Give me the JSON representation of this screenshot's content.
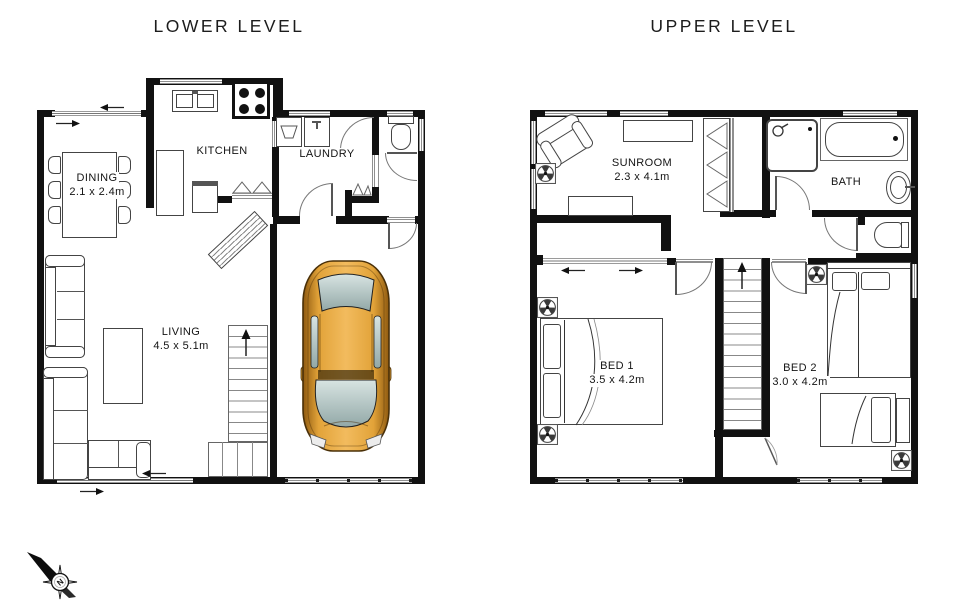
{
  "titles": {
    "lower": "LOWER LEVEL",
    "upper": "UPPER LEVEL"
  },
  "lower_level": {
    "rooms": {
      "dining": {
        "name": "DINING",
        "dims": "2.1 x 2.4m"
      },
      "kitchen": {
        "name": "KITCHEN",
        "dims": ""
      },
      "laundry": {
        "name": "LAUNDRY",
        "dims": ""
      },
      "living": {
        "name": "LIVING",
        "dims": "4.5 x 5.1m"
      }
    }
  },
  "upper_level": {
    "rooms": {
      "sunroom": {
        "name": "SUNROOM",
        "dims": "2.3 x 4.1m"
      },
      "bath": {
        "name": "BATH",
        "dims": ""
      },
      "bed1": {
        "name": "BED 1",
        "dims": "3.5 x 4.2m"
      },
      "bed2": {
        "name": "BED 2",
        "dims": "3.0 x 4.2m"
      }
    }
  },
  "compass": {
    "north_label": "N"
  },
  "colors": {
    "wall": "#111111",
    "window_line": "#8f8f8f",
    "door_line": "#777777",
    "car_gold_light": "#f2bb5e",
    "car_gold_mid": "#e2a339",
    "car_gold_dark": "#8f5a10",
    "car_glass_light": "#d8e4e2",
    "car_glass_dark": "#92a8a7"
  }
}
